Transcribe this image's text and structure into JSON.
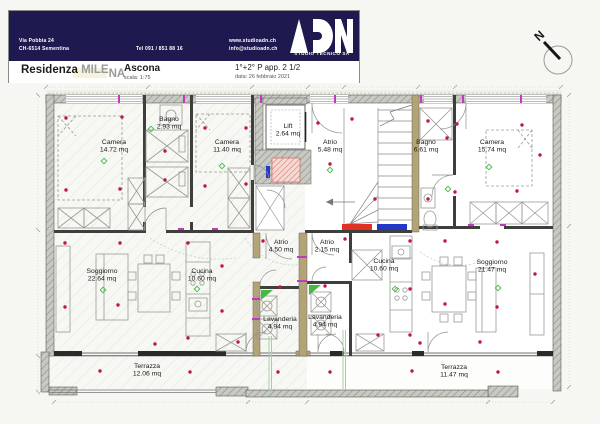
{
  "header": {
    "address_line1": "Via Pobbia 24",
    "address_line2": "CH-6514 Sementina",
    "phone": "Tel  091 / 851 88 16",
    "website": "www.studioadn.ch",
    "email": "info@studioadn.ch",
    "logo_text": "ADN",
    "logo_subtitle": "STUDIO TECNICO SA",
    "project_prefix": "Residenza",
    "project_name_1": "MILE",
    "project_name_2": "NA",
    "location": "Ascona",
    "scale": "scala: 1:75",
    "sheet_title": "1°+2° P app. 2 1/2",
    "date": "data: 26 febbraio 2021"
  },
  "compass": {
    "north_label": "N"
  },
  "colors": {
    "navy": "#1e1a4f",
    "light_dot": "#c0164e",
    "green_symbol": "#44b944",
    "magenta_marker": "#c03ac0",
    "wall_tan": "#b3a478",
    "radiator_red": "#e03224",
    "radiator_blue": "#2438c8",
    "legend_gray": "#6b6b6b"
  },
  "plan": {
    "unit": "mq",
    "rooms": [
      {
        "name": "Camera",
        "area": "14.72 mq",
        "x": 114,
        "y": 144
      },
      {
        "name": "Bagno",
        "area": "2.93 mq",
        "x": 169,
        "y": 121
      },
      {
        "name": "Camera",
        "area": "11.40 mq",
        "x": 227,
        "y": 144
      },
      {
        "name": "Lift",
        "area": "2.64 mq",
        "x": 288,
        "y": 128
      },
      {
        "name": "Atrio",
        "area": "5.48 mq",
        "x": 330,
        "y": 144
      },
      {
        "name": "Bagno",
        "area": "6.61 mq",
        "x": 426,
        "y": 144
      },
      {
        "name": "Camera",
        "area": "15.74 mq",
        "x": 492,
        "y": 144
      },
      {
        "name": "Soggiorno",
        "area": "22.64 mq",
        "x": 102,
        "y": 273
      },
      {
        "name": "Cucina",
        "area": "10.60 mq",
        "x": 202,
        "y": 273
      },
      {
        "name": "Atrio",
        "area": "4.50 mq",
        "x": 281,
        "y": 244
      },
      {
        "name": "Atrio",
        "area": "2.15 mq",
        "x": 327,
        "y": 244
      },
      {
        "name": "Cucina",
        "area": "10.60 mq",
        "x": 384,
        "y": 263
      },
      {
        "name": "Lavanderia",
        "area": "4.94 mq",
        "x": 280,
        "y": 321
      },
      {
        "name": "Lavanderia",
        "area": "4.94 mq",
        "x": 325,
        "y": 319
      },
      {
        "name": "Soggiorno",
        "area": "21.47 mq",
        "x": 492,
        "y": 264
      },
      {
        "name": "Terrazza",
        "area": "12.06 mq",
        "x": 147,
        "y": 368
      },
      {
        "name": "Terrazza",
        "area": "11.47 mq",
        "x": 454,
        "y": 369
      }
    ],
    "ceiling_lights": [
      [
        66,
        118
      ],
      [
        122,
        117
      ],
      [
        66,
        190
      ],
      [
        120,
        189
      ],
      [
        165,
        151
      ],
      [
        165,
        180
      ],
      [
        205,
        128
      ],
      [
        246,
        128
      ],
      [
        205,
        186
      ],
      [
        246,
        184
      ],
      [
        318,
        123
      ],
      [
        352,
        119
      ],
      [
        330,
        164
      ],
      [
        375,
        199
      ],
      [
        428,
        121
      ],
      [
        447,
        138
      ],
      [
        428,
        199
      ],
      [
        457,
        124
      ],
      [
        522,
        125
      ],
      [
        455,
        192
      ],
      [
        517,
        191
      ],
      [
        540,
        155
      ],
      [
        65,
        243
      ],
      [
        120,
        243
      ],
      [
        65,
        307
      ],
      [
        118,
        305
      ],
      [
        188,
        243
      ],
      [
        222,
        266
      ],
      [
        222,
        311
      ],
      [
        188,
        338
      ],
      [
        263,
        241
      ],
      [
        345,
        239
      ],
      [
        280,
        287
      ],
      [
        325,
        286
      ],
      [
        410,
        241
      ],
      [
        410,
        289
      ],
      [
        410,
        335
      ],
      [
        378,
        335
      ],
      [
        445,
        241
      ],
      [
        497,
        242
      ],
      [
        445,
        304
      ],
      [
        497,
        307
      ],
      [
        535,
        274
      ],
      [
        100,
        371
      ],
      [
        190,
        372
      ],
      [
        278,
        372
      ],
      [
        330,
        372
      ],
      [
        412,
        371
      ],
      [
        498,
        372
      ],
      [
        155,
        344
      ],
      [
        238,
        342
      ],
      [
        420,
        343
      ],
      [
        480,
        342
      ]
    ],
    "green_symbols": [
      [
        151,
        129
      ],
      [
        104,
        161
      ],
      [
        222,
        166
      ],
      [
        489,
        167
      ],
      [
        448,
        189
      ],
      [
        197,
        289
      ],
      [
        395,
        289
      ],
      [
        498,
        288
      ],
      [
        103,
        290
      ],
      [
        330,
        170
      ]
    ]
  }
}
